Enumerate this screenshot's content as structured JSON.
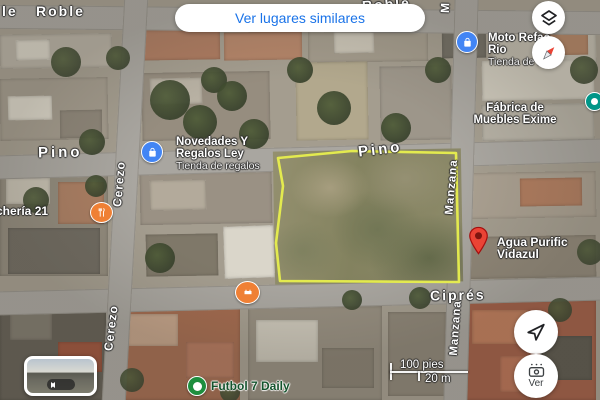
{
  "top_button": {
    "label": "Ver lugares similares"
  },
  "streets": {
    "roble_fragment": "le",
    "roble_left": "Roble",
    "roble_top": "Roble",
    "manzana_top_fragment": "M",
    "pino_left": "Pino",
    "pino_center": "Pino",
    "cerezo_upper": "Cerezo",
    "cerezo_lower": "Cerezo",
    "manzana_upper": "Manzana",
    "manzana_lower": "Manzana",
    "cipres": "Ciprés"
  },
  "pois": {
    "moto": {
      "name_line1": "Moto Refac",
      "name_line2": "Rio",
      "subtitle": "Tienda de repu"
    },
    "fabrica": {
      "name_line1": "Fábrica de",
      "name_line2": "Muebles Exime"
    },
    "novedades": {
      "name_line1": "Novedades Y",
      "name_line2": "Regalos Ley",
      "subtitle": "Tienda de regalos"
    },
    "loncheria": {
      "name": "chería 21"
    },
    "agua": {
      "name_line1": "Agua Purific",
      "name_line2": "Vidazul"
    },
    "futbol": {
      "name": "Futbol 7 Daily"
    }
  },
  "controls": {
    "streetview_label": "Ver"
  },
  "scale_bar": {
    "imperial": "100 pies",
    "metric": "20 m"
  },
  "colors": {
    "accent_blue": "#1a73e8",
    "polygon_yellow": "#e8ef4e",
    "pin_red": "#ea4335",
    "poi_blue": "#4285f4",
    "poi_orange": "#ef8035",
    "poi_green": "#1e8e3e",
    "poi_teal": "#009688"
  },
  "icons": {
    "layers-icon": "stacked-diamonds",
    "compass-icon": "red-white-needle",
    "shopping-bag-icon": "white-bag-on-blue",
    "restaurant-icon": "fork-knife-on-orange",
    "soccer-icon": "white-ball-on-green",
    "navigate-icon": "outlined-paper-plane",
    "camera-view-icon": "camera-with-dots",
    "map-pin-icon": "red-teardrop",
    "streetview-arrows-icon": "left-right-arrows"
  }
}
